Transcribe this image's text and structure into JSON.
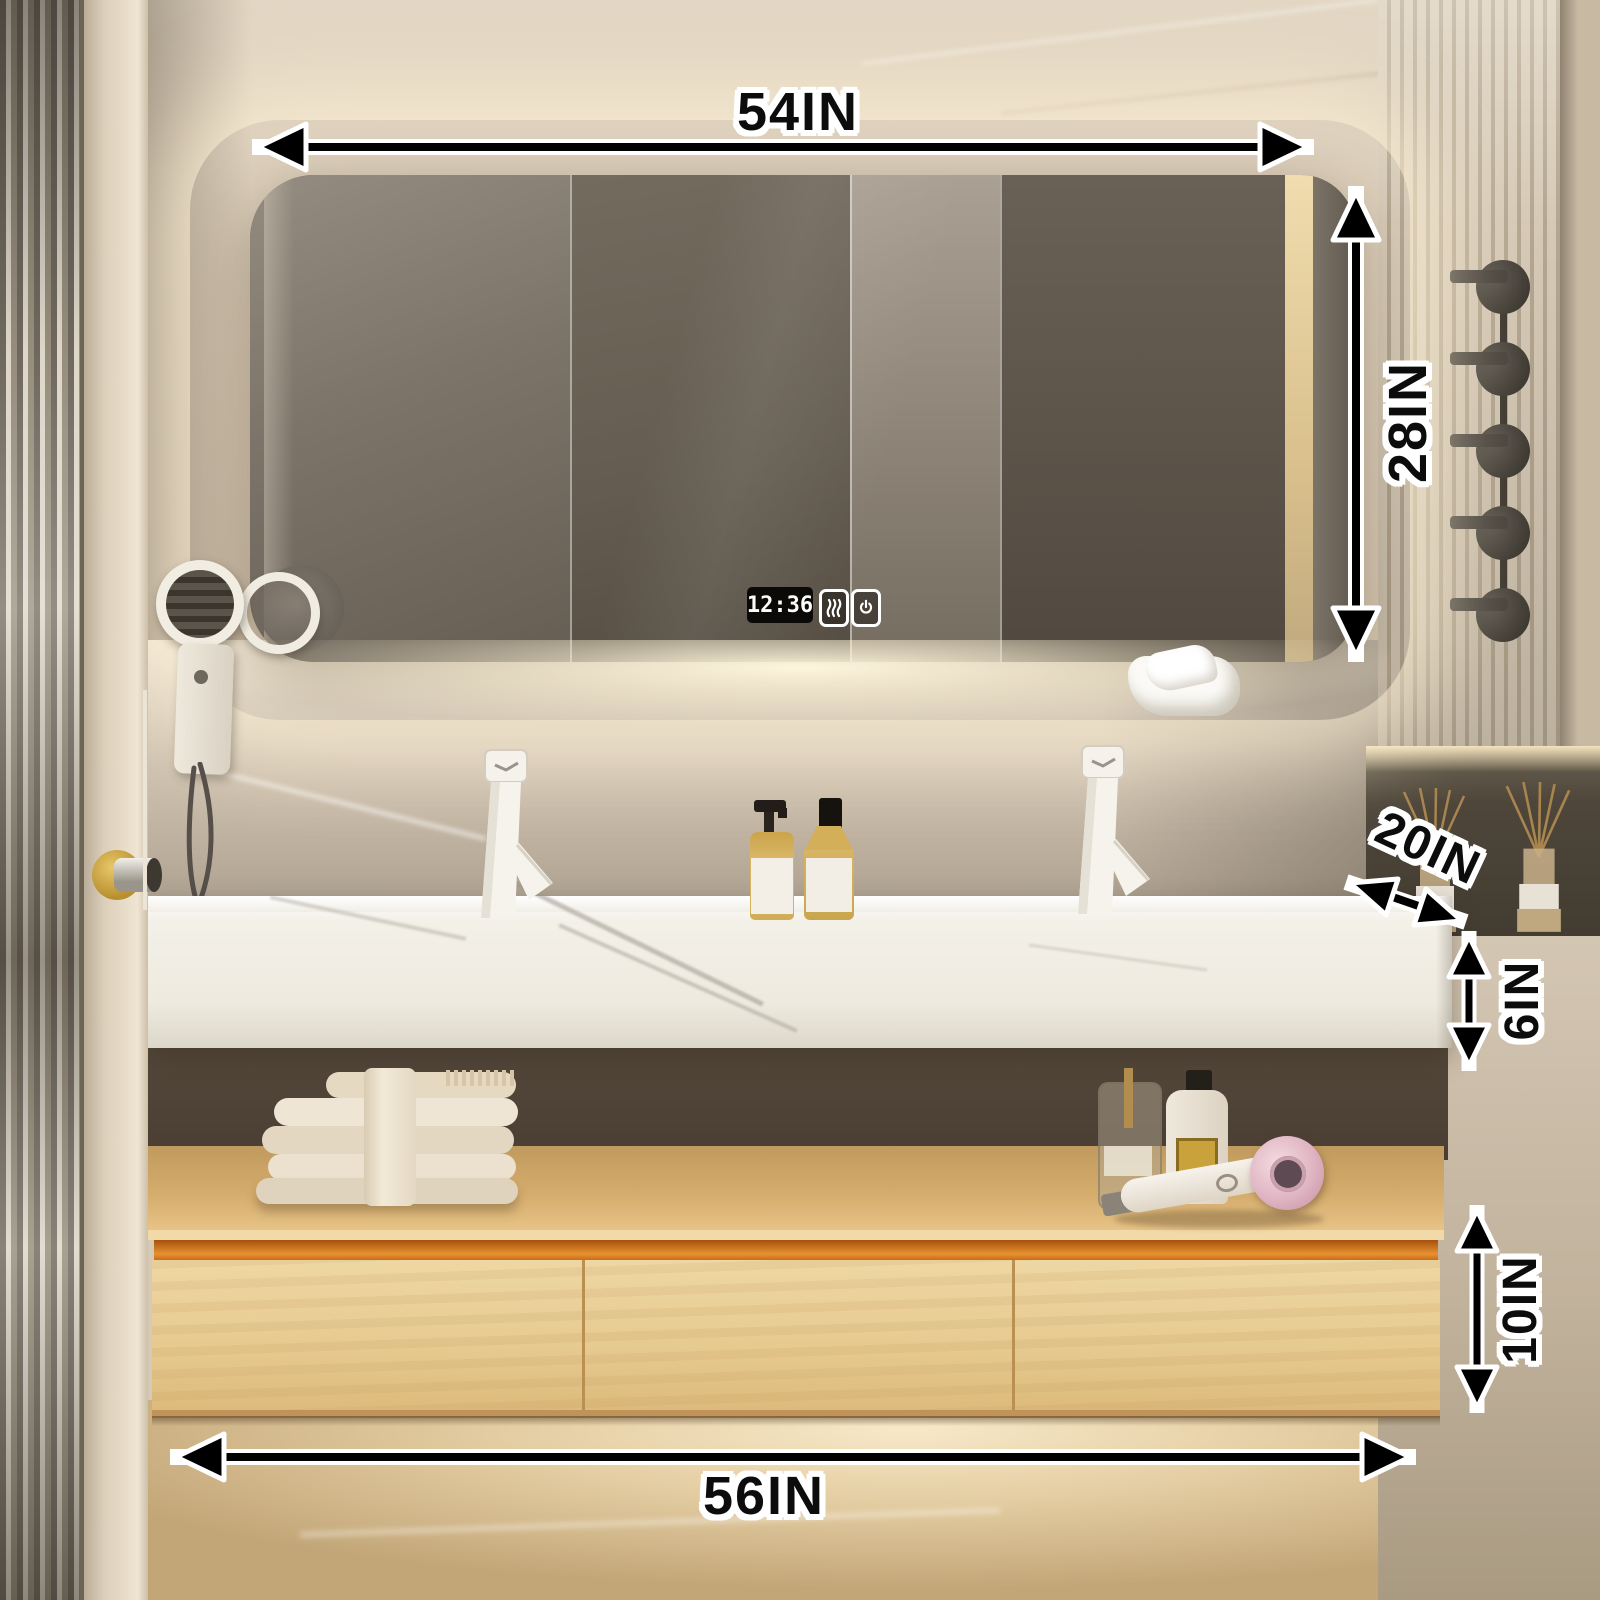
{
  "scene": {
    "description": "Bathroom double vanity with LED mirror cabinet, dimension callouts"
  },
  "annotations": {
    "mirror_width": "54IN",
    "mirror_height": "28IN",
    "counter_depth": "20IN",
    "counter_thickness": "6IN",
    "drawer_cabinet_height": "10IN",
    "vanity_width": "56IN"
  },
  "mirror_display": {
    "time": "12:36",
    "icons": [
      "defog-icon",
      "power-icon"
    ]
  },
  "colors": {
    "annotation_text": "#0c0c0c",
    "annotation_outline": "#ffffff",
    "arrow": "#000000",
    "led_glow": "#ffeccb",
    "wood": "#e8cd96",
    "recess_accent": "#dd7c20",
    "counter_marble": "#f4f1ea",
    "mirror_tint": "#6e655a",
    "wall_beige": "#d3c6b2",
    "floor_marble": "#e3cda6"
  }
}
